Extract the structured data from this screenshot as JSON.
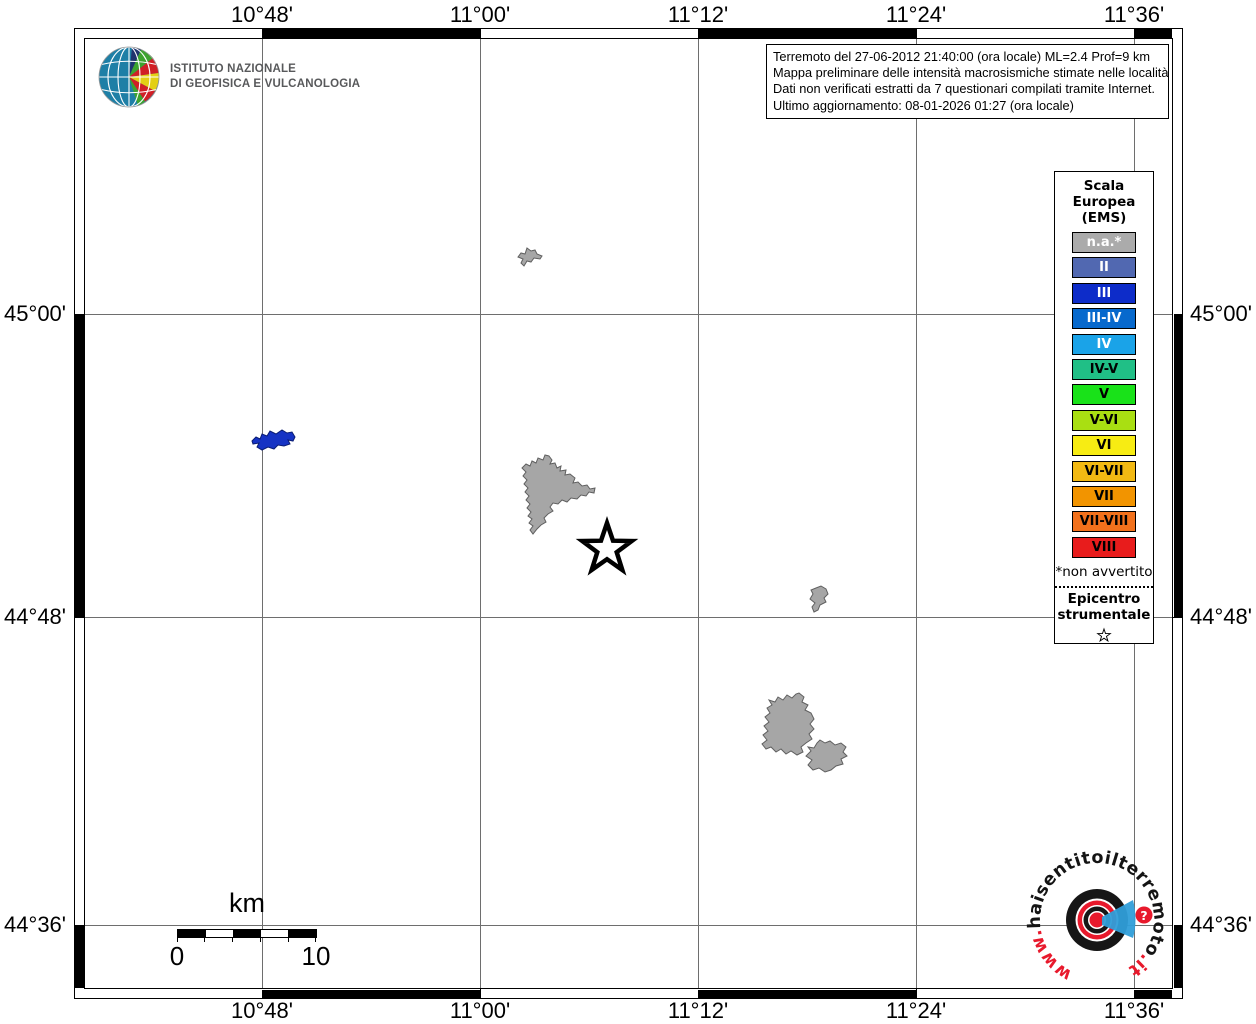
{
  "info_box": {
    "line1": "Terremoto del 27-06-2012 21:40:00 (ora locale) ML=2.4 Prof=9 km",
    "line2": "Mappa preliminare delle intensità macrosismiche stimate nelle località",
    "line3": "Dati non verificati estratti da 7 questionari compilati tramite Internet.",
    "line4": "Ultimo aggiornamento: 08-01-2026 01:27 (ora locale)"
  },
  "ingv_logo": {
    "org_line1": "ISTITUTO NAZIONALE",
    "org_line2": "DI GEOFISICA E VULCANOLOGIA"
  },
  "axes": {
    "top": [
      "10°48'",
      "11°00'",
      "11°12'",
      "11°24'",
      "11°36'"
    ],
    "bottom": [
      "10°48'",
      "11°00'",
      "11°12'",
      "11°24'",
      "11°36'"
    ],
    "left": [
      "45°00'",
      "44°48'",
      "44°36'"
    ],
    "right": [
      "45°00'",
      "44°48'",
      "44°36'"
    ]
  },
  "legend": {
    "title_lines": [
      "Scala",
      "Europea",
      "(EMS)"
    ],
    "items": [
      {
        "label": "n.a.*",
        "color": "#ababab",
        "text_color": "#ffffff"
      },
      {
        "label": "II",
        "color": "#5168b1",
        "text_color": "#ffffff"
      },
      {
        "label": "III",
        "color": "#0d2cc9",
        "text_color": "#ffffff"
      },
      {
        "label": "III-IV",
        "color": "#0769cd",
        "text_color": "#ffffff"
      },
      {
        "label": "IV",
        "color": "#1aa3e8",
        "text_color": "#ffffff"
      },
      {
        "label": "IV-V",
        "color": "#20bf86",
        "text_color": "#000000"
      },
      {
        "label": "V",
        "color": "#19e219",
        "text_color": "#000000"
      },
      {
        "label": "V-VI",
        "color": "#a9df12",
        "text_color": "#000000"
      },
      {
        "label": "VI",
        "color": "#f7ec13",
        "text_color": "#000000"
      },
      {
        "label": "VI-VII",
        "color": "#f2b913",
        "text_color": "#000000"
      },
      {
        "label": "VII",
        "color": "#f29400",
        "text_color": "#000000"
      },
      {
        "label": "VII-VIII",
        "color": "#f2711c",
        "text_color": "#000000"
      },
      {
        "label": "VIII",
        "color": "#e81c1c",
        "text_color": "#000000"
      }
    ],
    "footnote": "*non avvertito",
    "epicenter_line1": "Epicentro",
    "epicenter_line2": "strumentale"
  },
  "scalebar": {
    "unit": "km",
    "start_label": "0",
    "end_label": "10"
  },
  "map": {
    "locality_felt_color": "#1633c4",
    "locality_not_felt_color": "#a6a6a6",
    "gridline_color": "#6e6e6e"
  },
  "watermark": {
    "url_prefix": "www.",
    "url_mid": "haisentitoilterremoto",
    "url_suffix": ".it",
    "question_mark": "?"
  }
}
